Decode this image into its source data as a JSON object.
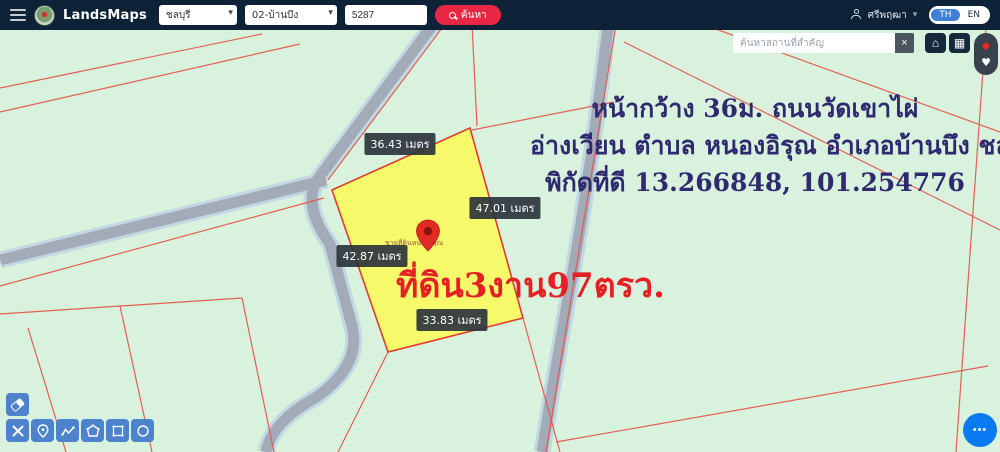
{
  "header": {
    "brand": "LandsMaps",
    "province": "ชลบุรี",
    "district": "02-บ้านบึง",
    "parcel_no": "5287",
    "search_label": "ค้นหา",
    "username": "ศรีพฤฒา",
    "lang": {
      "th": "TH",
      "en": "EN"
    }
  },
  "poi_search": {
    "placeholder": "ค้นหาสถานที่สำคัญ"
  },
  "icons": {
    "chevron": "▾",
    "close": "×",
    "home": "⌂",
    "grid": "▦",
    "diamond": "◆",
    "heart": "♥",
    "fab_dots": "•••"
  },
  "parcel": {
    "dimensions": {
      "top": "36.43 เมตร",
      "right": "47.01 เมตร",
      "left": "42.87 เมตร",
      "bottom": "33.83 เมตร"
    },
    "area_text": "ที่ดิน3งาน97ตรว.",
    "watermark": "ขายที่ดินหนองอิรุณ"
  },
  "annotation": {
    "line1": "หน้ากว้าง 36ม. ถนนวัดเขาไผ่",
    "line2": "อ่างเวียน ตำบล หนองอิรุณ อำเภอบ้านบึง ชลบุรี",
    "line3": "พิกัดที่ดี 13.266848, 101.254776"
  },
  "colors": {
    "header_bg": "#0d2137",
    "accent_red": "#e82743",
    "map_bg": "#d9f2de",
    "parcel_yellow": "#f5f96a",
    "parcel_border": "#e03c30",
    "cadastral_line": "#e4574b",
    "road_core": "#a4abb8",
    "road_casing": "#c2d8e2",
    "annotation_navy": "#2f2a70",
    "big_red_text": "#e52025",
    "toolbar_blue": "#4d82cc",
    "fab_blue": "#0b79f1"
  }
}
